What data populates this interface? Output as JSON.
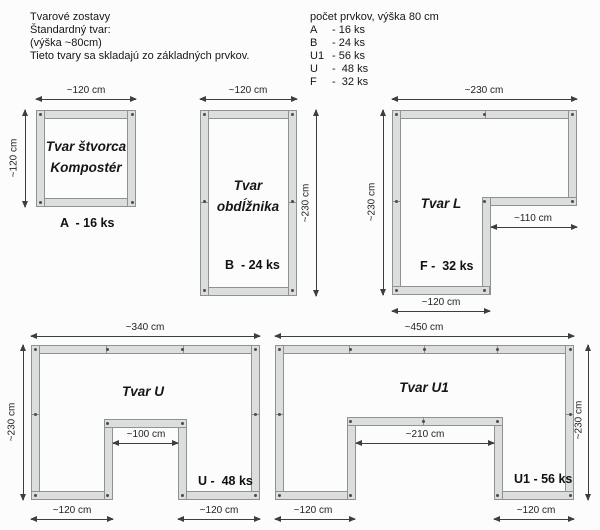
{
  "header": {
    "lines": [
      "Tvarové zostavy",
      "Štandardný tvar:",
      "(výška ~80cm)",
      "Tieto tvary sa skladajú zo základných prvkov."
    ]
  },
  "legend": {
    "title": "počet prvkov, výška 80 cm",
    "items": [
      {
        "code": "A",
        "count": "- 16 ks"
      },
      {
        "code": "B",
        "count": "- 24 ks"
      },
      {
        "code": "U1",
        "count": "- 56 ks"
      },
      {
        "code": "U",
        "count": "-  48 ks"
      },
      {
        "code": "F",
        "count": "-  32 ks"
      }
    ]
  },
  "shapes": {
    "square": {
      "name_lines": [
        "Tvar štvorca",
        "Kompostér"
      ],
      "count_label": "A  - 16 ks",
      "dims": {
        "top": "~120 cm",
        "left": "~120 cm"
      }
    },
    "rectangle": {
      "name_lines": [
        "Tvar",
        "obdĺžnika"
      ],
      "count_label": "B  - 24 ks",
      "dims": {
        "top": "~120 cm",
        "right": "~230 cm"
      }
    },
    "l": {
      "name": "Tvar L",
      "count_label": "F -  32 ks",
      "dims": {
        "top": "~230 cm",
        "left": "~230 cm",
        "notch": "~110 cm",
        "bottom": "~120 cm"
      }
    },
    "u": {
      "name": "Tvar U",
      "count_label": "U -  48 ks",
      "dims": {
        "top": "~340 cm",
        "left": "~230 cm",
        "notch": "~100 cm",
        "bottom_left": "~120 cm",
        "bottom_right": "~120 cm"
      }
    },
    "u1": {
      "name": "Tvar U1",
      "count_label": "U1 - 56 ks",
      "dims": {
        "top": "~450 cm",
        "right": "~230 cm",
        "notch": "~210 cm",
        "bottom_left": "~120 cm",
        "bottom_right": "~120 cm"
      }
    }
  },
  "colors": {
    "wall_fill": "#dcdddd",
    "wall_border": "#8d9294",
    "dimension_line": "#3e3e3e",
    "text": "#1a1a1a",
    "background": "#fcfcfc"
  }
}
